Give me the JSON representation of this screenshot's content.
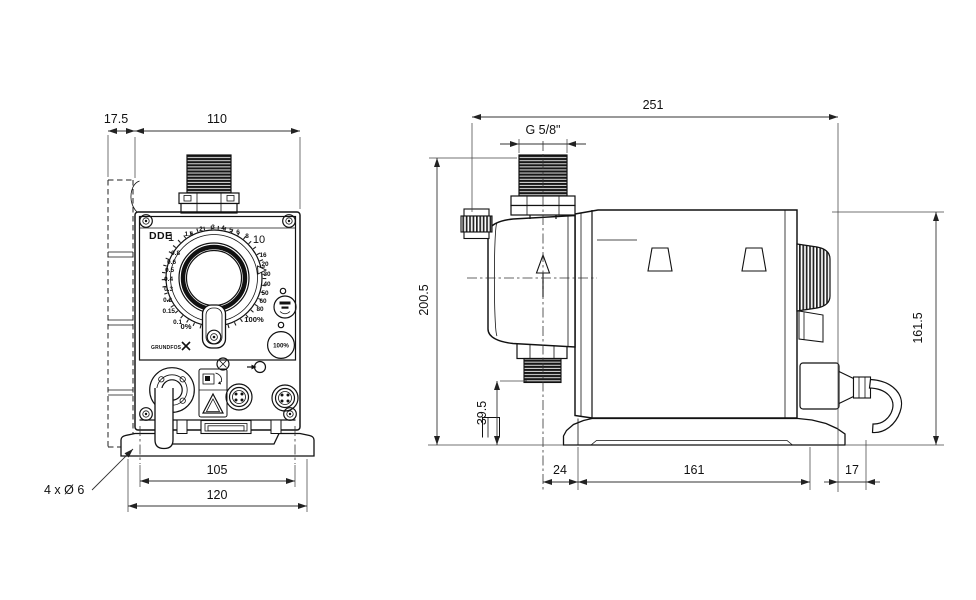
{
  "front_view": {
    "dims": {
      "plate_offset": "17.5",
      "body_width": "110",
      "slot_spacing": "105",
      "base_width": "120",
      "mounting_holes": "4 x Ø 6"
    },
    "panel": {
      "model": "DDE",
      "brand": "GRUNDFOS",
      "prime_button": "100%",
      "dial": {
        "major_min": "1",
        "major_max": "10",
        "left": [
          "0.8",
          "0.6",
          "0.5",
          "0.4",
          "0.3",
          "0.2",
          "0.15",
          "0.1"
        ],
        "top": [
          "1.6",
          "2",
          "3",
          "4",
          "5",
          "6",
          "8"
        ],
        "right": [
          "16",
          "20",
          "30",
          "40",
          "50",
          "60",
          "80"
        ],
        "zero": "0%",
        "full": "100%"
      }
    }
  },
  "side_view": {
    "dims": {
      "overall_depth": "251",
      "connection_thread": "G 5/8\"",
      "overall_height": "200.5",
      "housing_height": "161.5",
      "valve_clearance": "39.5",
      "head_to_base": "24",
      "base_length": "161",
      "cable_gland": "17"
    }
  }
}
